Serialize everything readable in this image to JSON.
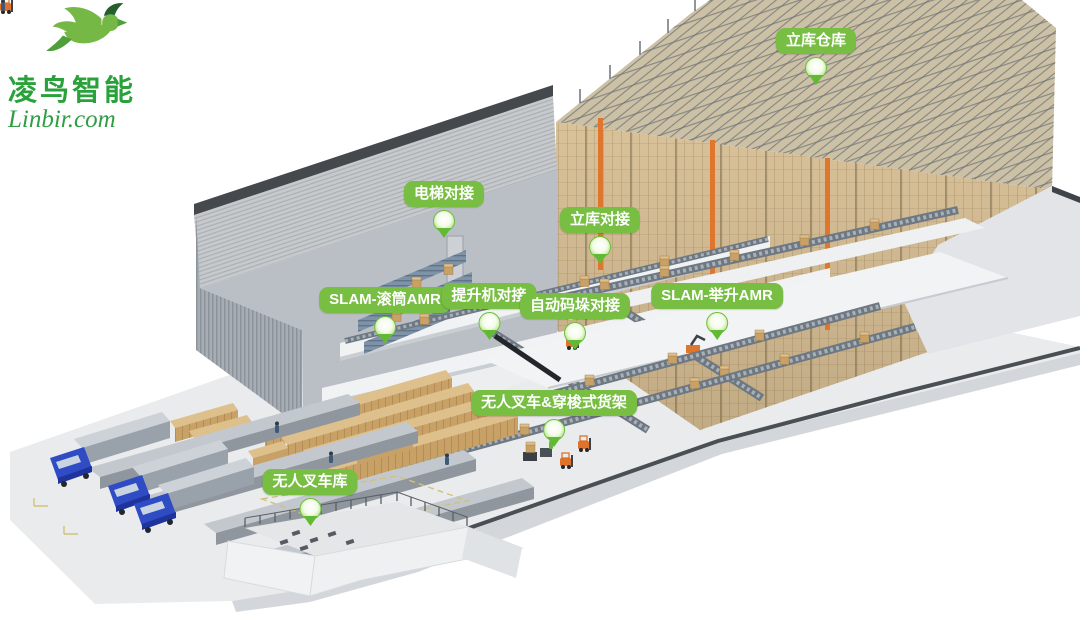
{
  "brand": {
    "name": "凌鸟智能",
    "website": "Linbir.com"
  },
  "callouts": [
    {
      "label": "立库仓库"
    },
    {
      "label": "电梯对接"
    },
    {
      "label": "立库对接"
    },
    {
      "label": "SLAM-滚筒AMR"
    },
    {
      "label": "提升机对接"
    },
    {
      "label": "自动码垛对接"
    },
    {
      "label": "SLAM-举升AMR"
    },
    {
      "label": "无人叉车&穿梭式货架"
    },
    {
      "label": "无人叉车库"
    }
  ],
  "colors": {
    "callout_green": "#77be43",
    "pin_green": "#6cc23c",
    "logo_green": "#2aa13b",
    "logo_dark_green": "#235f2f",
    "rack_tan": "#d9c29a",
    "crane_orange": "#e0762e",
    "truck_blue": "#2f4cc4",
    "box_tan": "#c8a166",
    "structure_gray": "#b9bfc5"
  }
}
